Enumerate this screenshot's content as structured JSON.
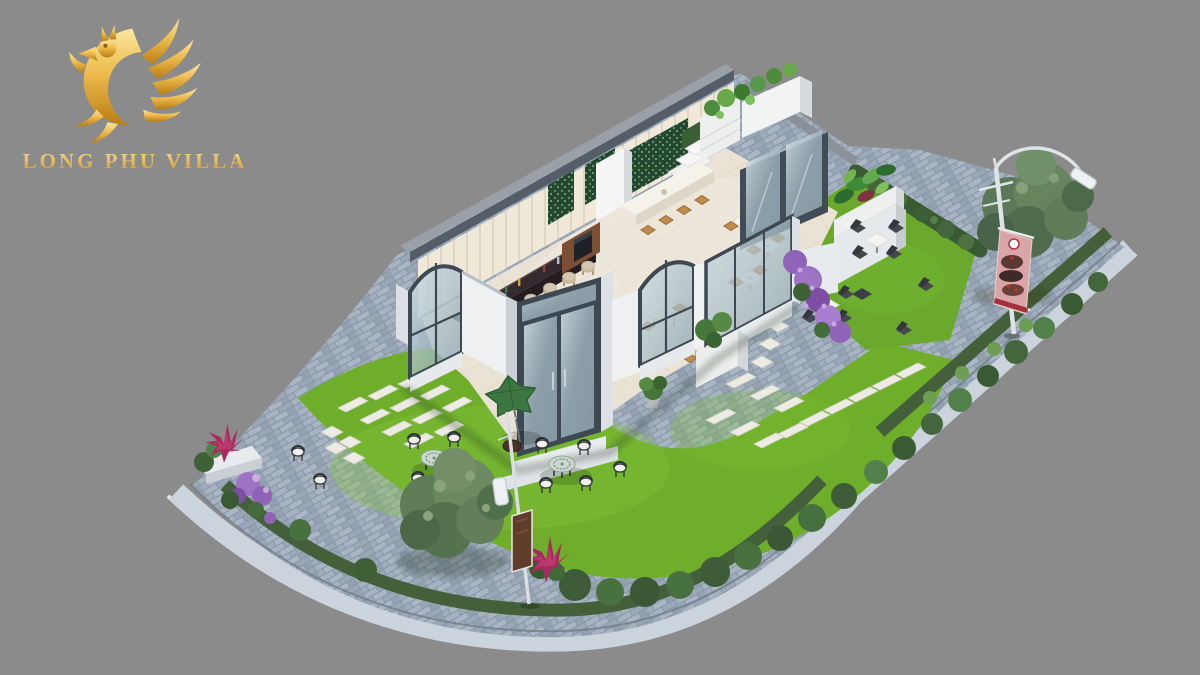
{
  "image": {
    "kind": "3d-architectural-render",
    "subject": "Corner coffee-shop villa with landscaped garden, brick plaza and street lamps",
    "background_color": "#8b8b8b"
  },
  "logo": {
    "brand": "LONG PHU VILLA",
    "mark": "phoenix-dragon-icon",
    "gold_light": "#fbe7a0",
    "gold": "#eebc4e",
    "gold_dark": "#b97c14"
  },
  "palette": {
    "grass": "#6fae2b",
    "grass_highlight": "#82c238",
    "brick_paving": "#96a3b3",
    "sidewalk": "#cbd4dd",
    "building_wall": "#eef0f1",
    "wall_cap_dark": "#555e68",
    "frame_dark": "#3e4852",
    "interior_floor": "#eae3d5",
    "back_wall_cream": "#f0e9da",
    "bar_counter": "#352a2f",
    "stool_beige": "#d4c8b2",
    "wood": "#c08c4e",
    "foliage_dark": "#3f5f37",
    "tree_gray_green": "#5f7d57",
    "hedge": "#3a5a33",
    "flower_purple": "#9d74c4",
    "flower_magenta": "#a62a5e",
    "umbrella_green": "#3c7742",
    "banner_pink": "#d9a5a8",
    "banner_red_band": "#a3303c",
    "lamp_white": "#dfe4e8"
  },
  "scene_elements": [
    "phoenix-logo",
    "brand-wordmark",
    "cafe-building",
    "back-wall",
    "mosaic-feature-panels",
    "bar-counter",
    "bar-stools",
    "coffee-station",
    "island-counter",
    "wood-stools",
    "round-bistro-tables",
    "indoor-dining-tables",
    "indoor-plant",
    "glass-arch-window-left",
    "glass-entrance-doors",
    "glass-arch-window-right",
    "glass-curtain-wall",
    "rooftop-planters",
    "tropical-planter",
    "roof-glass-door",
    "interior-steps",
    "terrace-lawn",
    "terrace-hedge",
    "terrace-dining-sets",
    "purple-flower-bushes",
    "front-lawn",
    "stepping-stones",
    "garden-umbrella",
    "glass-garden-tables",
    "garden-chairs",
    "big-garden-tree",
    "street-tree",
    "street-lamp-with-banner",
    "advertising-banner",
    "small-street-lamp",
    "sign-panel",
    "corner-flower-planter",
    "magenta-spiky-plant",
    "shrub-border",
    "brick-pavement",
    "sidewalk-curb"
  ]
}
